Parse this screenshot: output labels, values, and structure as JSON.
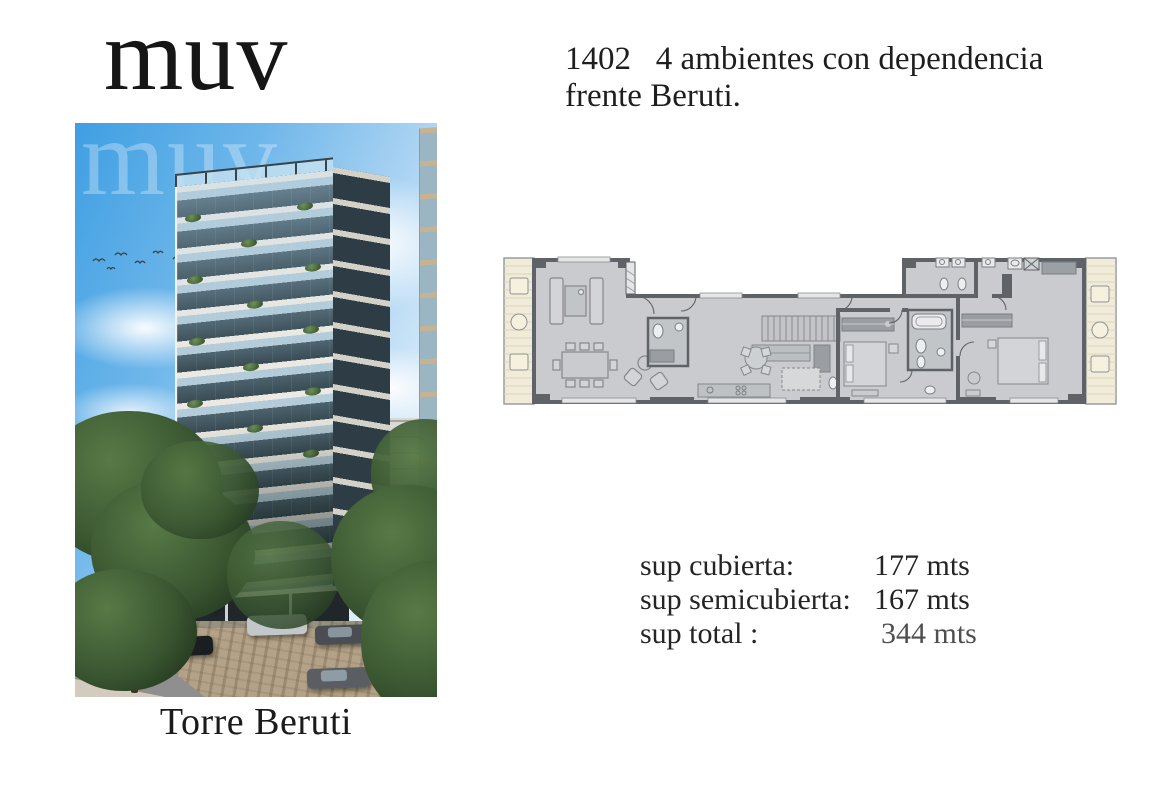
{
  "brand": {
    "logo_text": "muv",
    "watermark_text": "muv"
  },
  "listing": {
    "unit_line": "1402   4 ambientes con dependencia",
    "location_line": "frente Beruti."
  },
  "photo": {
    "caption": "Torre Beruti"
  },
  "surfaces": {
    "rows": [
      {
        "label": "sup cubierta:",
        "value": "177 mts"
      },
      {
        "label": "sup semicubierta:",
        "value": "167 mts"
      },
      {
        "label": "sup total :",
        "value": "344 mts"
      }
    ]
  },
  "colors": {
    "text": "#232323",
    "muted_value": "#4f4f4f",
    "plan_wall": "#5f6266",
    "plan_floor": "#c9cbce",
    "plan_balcony": "#f1ebd9",
    "sky_blue": "#3f9fe2",
    "foliage_green": "#3a5631"
  }
}
